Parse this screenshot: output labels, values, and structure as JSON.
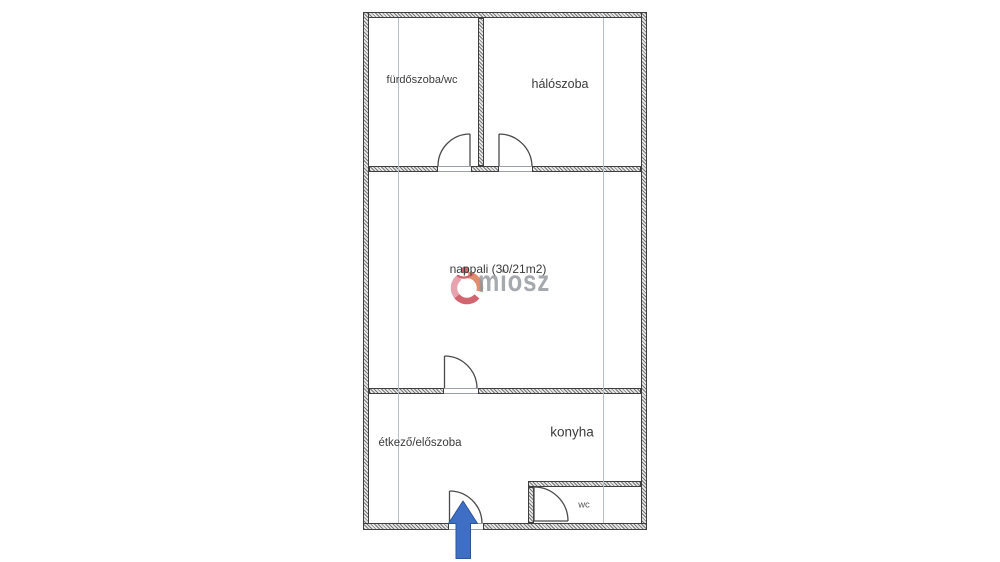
{
  "floorplan": {
    "rooms": [
      {
        "id": "furdoszoba",
        "label": "fürdőszoba/wc"
      },
      {
        "id": "haloszoba",
        "label": "hálószoba"
      },
      {
        "id": "nappali",
        "label": "nappali (30/21m2)"
      },
      {
        "id": "etkezo",
        "label": "étkező/előszoba"
      },
      {
        "id": "konyha",
        "label": "konyha"
      },
      {
        "id": "wc",
        "label": "wc"
      }
    ],
    "watermark": {
      "text": "miosz",
      "text_color": "#7d828a",
      "logo_colors": {
        "pink": "#e294a0",
        "red": "#c94b58",
        "orange": "#dd7a55"
      }
    },
    "colors": {
      "wall": "#3e3e3e",
      "door": "#4a4a4a",
      "guide_line": "#b7bfc9",
      "entrance_arrow": "#3e6fc4",
      "label_text": "#3b3b3b",
      "background": "#ffffff"
    }
  }
}
